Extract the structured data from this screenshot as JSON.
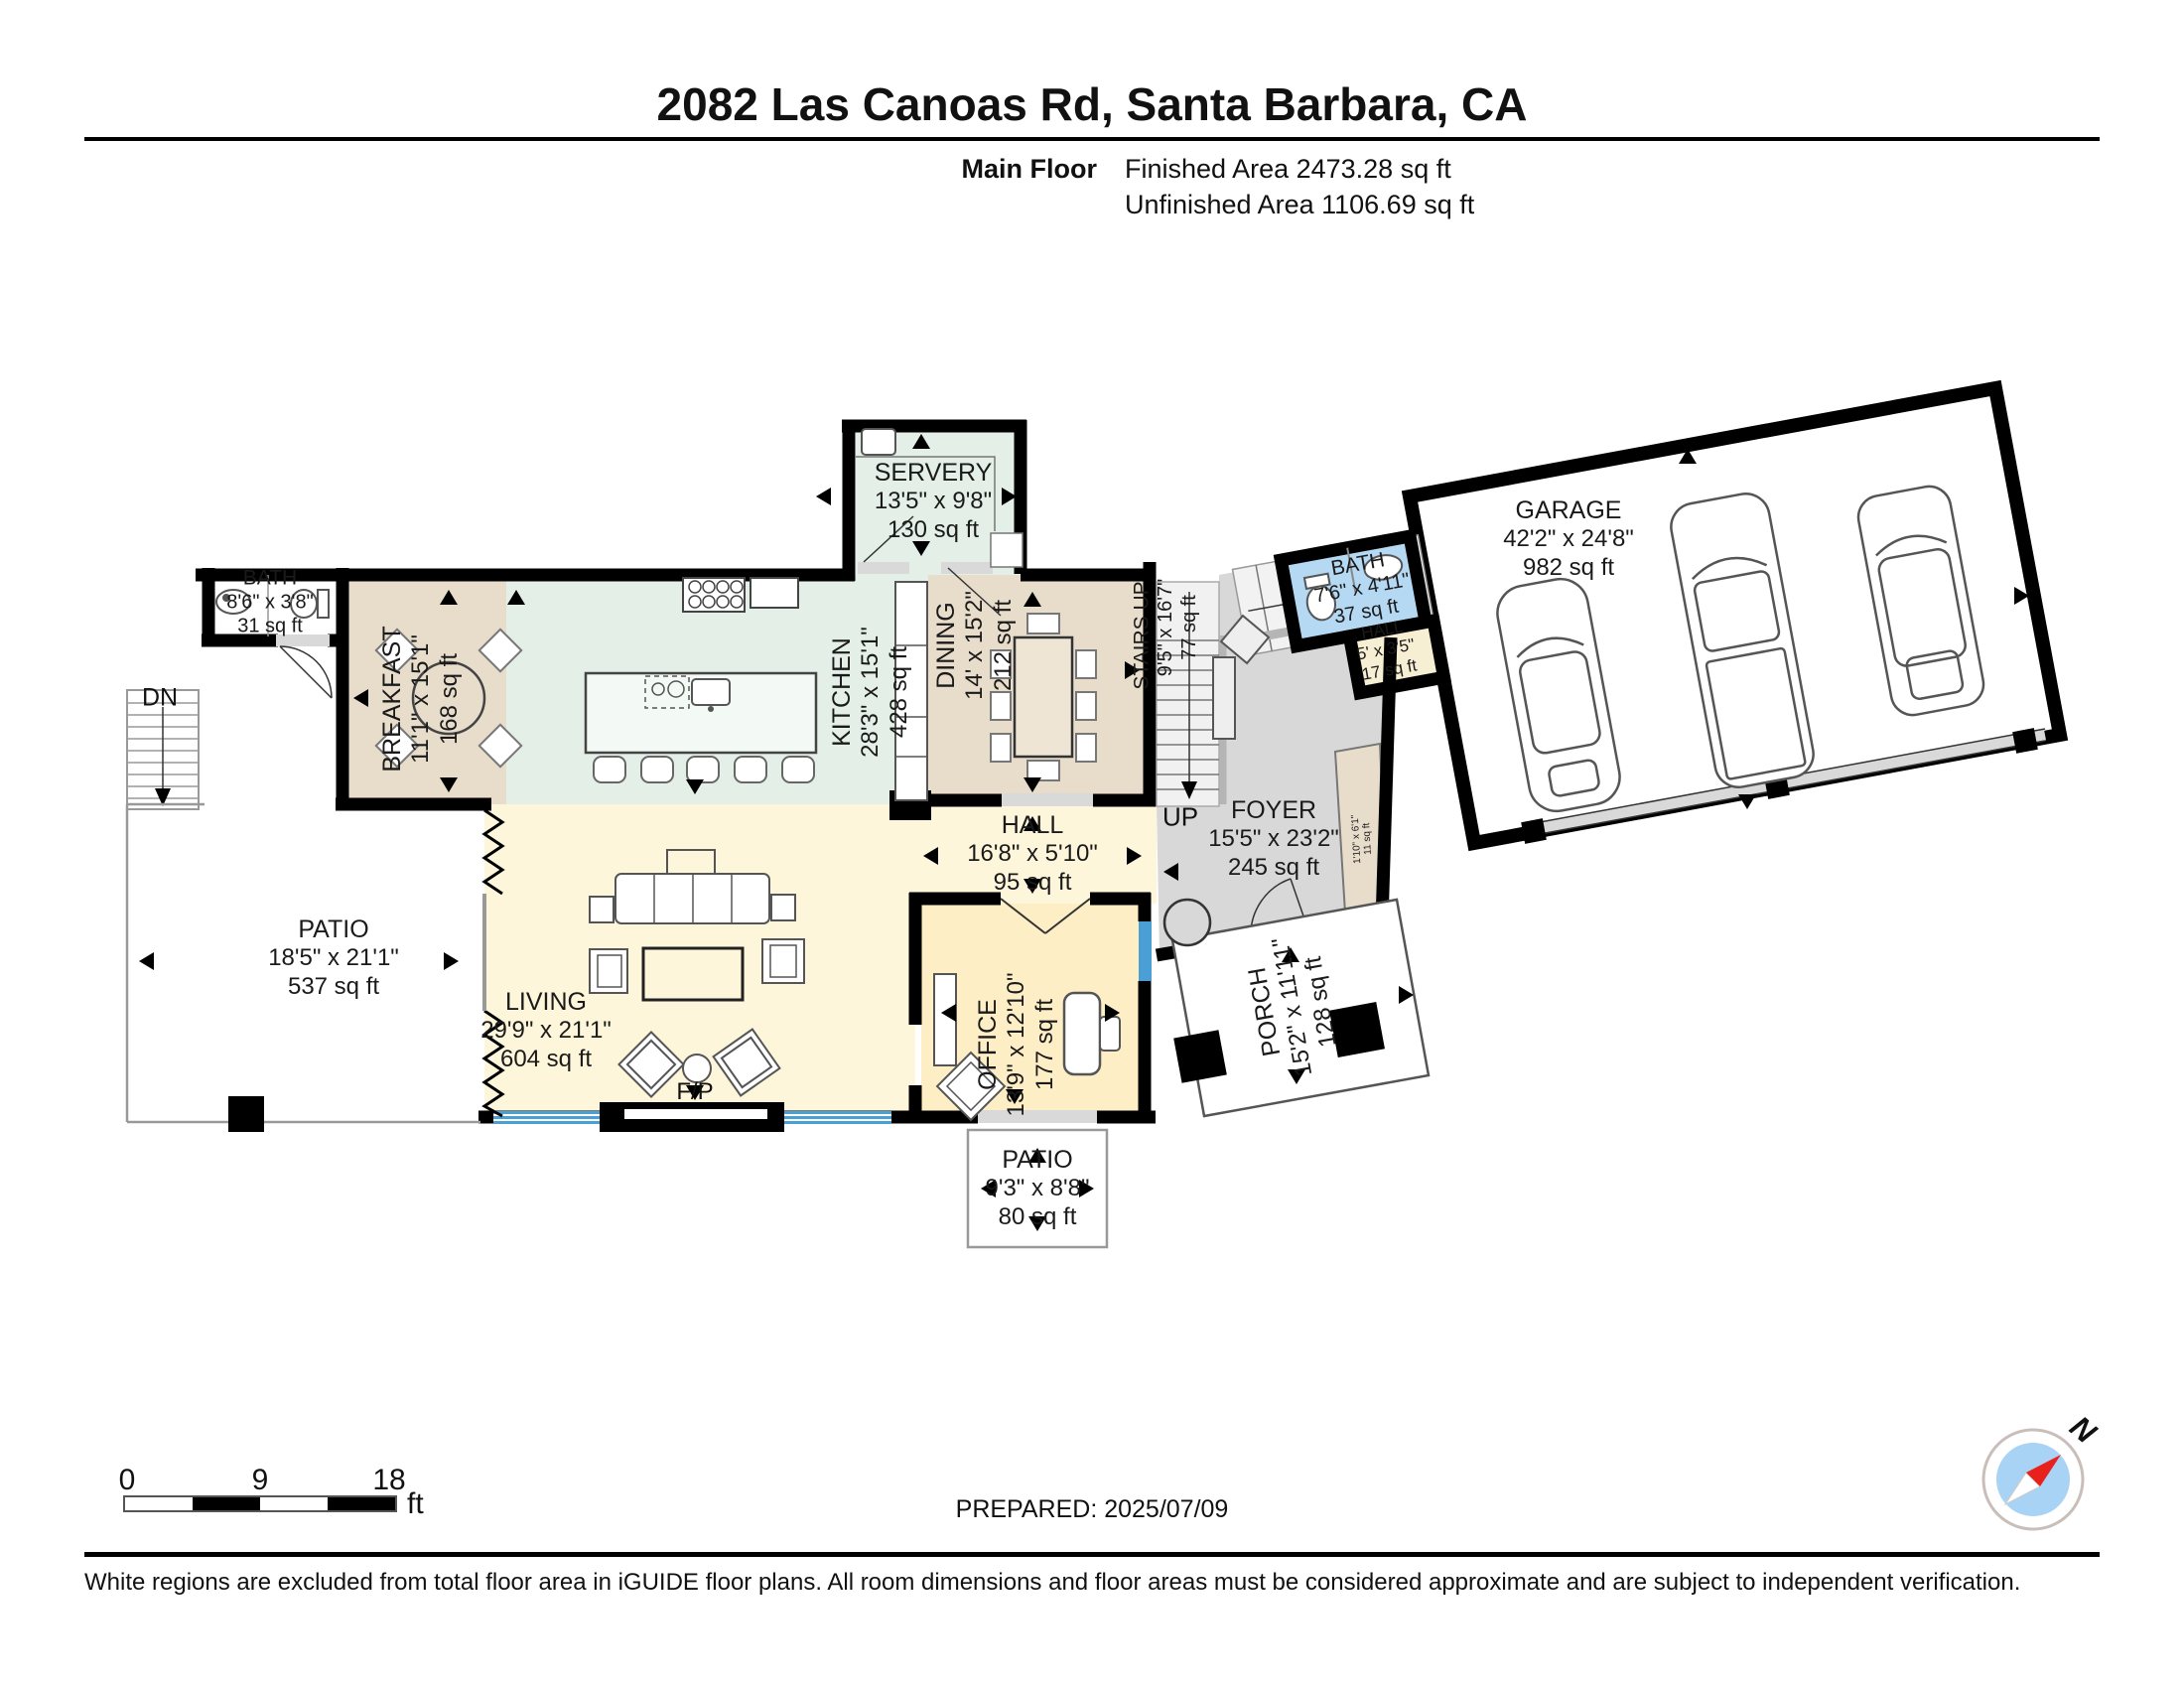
{
  "header": {
    "title": "2082 Las Canoas Rd, Santa Barbara, CA",
    "floor_label": "Main Floor",
    "finished_area": "Finished Area 2473.28 sq ft",
    "unfinished_area": "Unfinished Area 1106.69 sq ft"
  },
  "rooms": {
    "servery": {
      "name": "SERVERY",
      "dims": "13'5\" x 9'8\"",
      "area": "130 sq ft"
    },
    "garage": {
      "name": "GARAGE",
      "dims": "42'2\" x 24'8\"",
      "area": "982 sq ft"
    },
    "bath_upper": {
      "name": "BATH",
      "dims": "7'6\" x 4'11\"",
      "area": "37 sq ft"
    },
    "hall_upper": {
      "name": "HALL",
      "dims": "5' x 3'5\"",
      "area": "17 sq ft"
    },
    "breakfast": {
      "name": "BREAKFAST",
      "dims": "11'1\" x 15'1\"",
      "area": "168 sq ft"
    },
    "kitchen": {
      "name": "KITCHEN",
      "dims": "28'3\" x 15'1\"",
      "area": "428 sq ft"
    },
    "dining": {
      "name": "DINING",
      "dims": "14' x 15'2\"",
      "area": "212 sq ft"
    },
    "stairs": {
      "name": "STAIRS UP",
      "dims": "9'5\" x 16'7\"",
      "area": "77 sq ft"
    },
    "bath_main": {
      "name": "BATH",
      "dims": "8'6\" x 3'8\"",
      "area": "31 sq ft"
    },
    "hall": {
      "name": "HALL",
      "dims": "16'8\" x 5'10\"",
      "area": "95 sq ft"
    },
    "foyer": {
      "name": "FOYER",
      "dims": "15'5\" x 23'2\"",
      "area": "245 sq ft"
    },
    "living": {
      "name": "LIVING",
      "dims": "29'9\" x 21'1\"",
      "area": "604 sq ft"
    },
    "office": {
      "name": "OFFICE",
      "dims": "13'9\" x 12'10\"",
      "area": "177 sq ft"
    },
    "patio_left": {
      "name": "PATIO",
      "dims": "18'5\" x 21'1\"",
      "area": "537 sq ft"
    },
    "porch": {
      "name": "PORCH",
      "dims": "15'2\" x 11'11\"",
      "area": "128 sq ft"
    },
    "patio_rear": {
      "name": "PATIO",
      "dims": "9'3\" x 8'8\"",
      "area": "80 sq ft"
    },
    "hall_tiny": {
      "dims": "1'10\" x 6'1\"",
      "area": "11 sq ft"
    }
  },
  "annotations": {
    "down": "DN",
    "up": "UP",
    "fireplace": "F/P",
    "north": "N"
  },
  "scale_bar": {
    "start": "0",
    "mid": "9",
    "end": "18",
    "unit": "ft"
  },
  "prepared": "PREPARED: 2025/07/09",
  "footer": {
    "disclaimer": "White regions are excluded from total floor area in iGUIDE floor plans. All room dimensions and floor areas must be considered approximate and are subject to independent verification."
  },
  "colors": {
    "kitchen_green": "#e3efe7",
    "dining_tan": "#e8ddcb",
    "living_yellow": "#fdf6da",
    "office_yellow": "#fdeec5",
    "foyer_gray": "#d8d8d8",
    "bath_blue": "#b5d8f3",
    "hall_cream": "#f7efd3",
    "window_blue": "#4a9fd5",
    "compass_blue": "#a9d3f4",
    "needle_red": "#e8211d"
  }
}
